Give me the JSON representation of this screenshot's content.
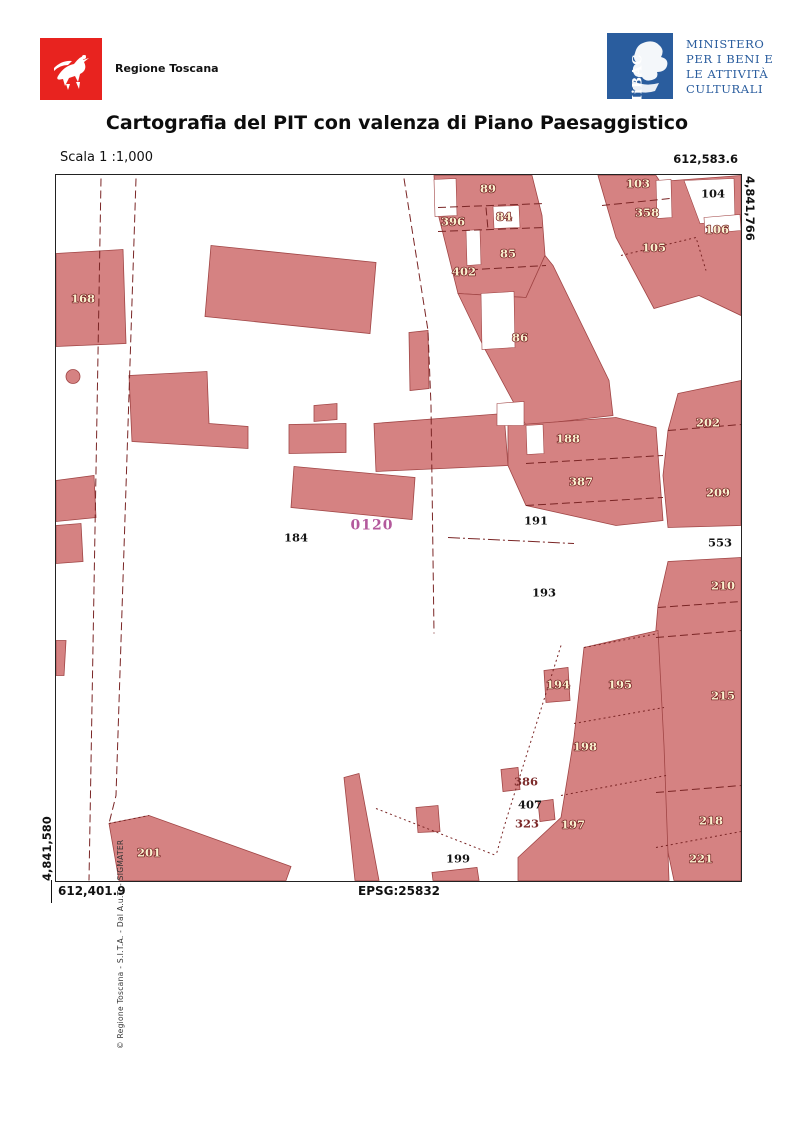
{
  "header": {
    "region_name": "Regione Toscana",
    "ministry_logo_text": "MiBAC",
    "ministry": {
      "l1": "MINISTERO",
      "l2": "PER I BENI E",
      "l3": "LE ATTIVITÀ",
      "l4": "CULTURALI"
    },
    "title": "Cartografia del PIT con valenza di Piano Paesaggistico",
    "scale_label": "Scala 1 :1,000"
  },
  "map": {
    "coordinates": {
      "top_right_easting": "612,583.6",
      "right_northing": "4,841,766",
      "left_northing": "4,841,580",
      "bottom_left_easting": "612,401.9",
      "epsg": "EPSG:25832"
    },
    "credit": "© Regione Toscana - S.I.T.A. - Dal A.u.T. - SIGMATER",
    "colors": {
      "building_fill": "#d58282",
      "building_stroke": "#a04545",
      "parcel_label_light": "#fbf2d0",
      "parcel_label_outline": "#7c2a2a",
      "parcel_label_dark": "#151515",
      "zone_label_purple": "#b3599c",
      "region_logo_red": "#e8231f",
      "ministry_blue": "#2a5d9e"
    },
    "parcels": [
      {
        "t": "168",
        "x": 27,
        "y": 123,
        "s": "A"
      },
      {
        "t": "89",
        "x": 432,
        "y": 13,
        "s": "A"
      },
      {
        "t": "396",
        "x": 397,
        "y": 46,
        "s": "A"
      },
      {
        "t": "84",
        "x": 448,
        "y": 41,
        "s": "A"
      },
      {
        "t": "85",
        "x": 452,
        "y": 78,
        "s": "A"
      },
      {
        "t": "402",
        "x": 408,
        "y": 96,
        "s": "A"
      },
      {
        "t": "86",
        "x": 464,
        "y": 162,
        "s": "A"
      },
      {
        "t": "103",
        "x": 582,
        "y": 8,
        "s": "A"
      },
      {
        "t": "104",
        "x": 657,
        "y": 18,
        "s": "B"
      },
      {
        "t": "358",
        "x": 591,
        "y": 37,
        "s": "A"
      },
      {
        "t": "106",
        "x": 661,
        "y": 54,
        "s": "A"
      },
      {
        "t": "105",
        "x": 598,
        "y": 72,
        "s": "A"
      },
      {
        "t": "188",
        "x": 512,
        "y": 263,
        "s": "A"
      },
      {
        "t": "387",
        "x": 525,
        "y": 306,
        "s": "A"
      },
      {
        "t": "191",
        "x": 480,
        "y": 345,
        "s": "B"
      },
      {
        "t": "193",
        "x": 488,
        "y": 417,
        "s": "B"
      },
      {
        "t": "184",
        "x": 240,
        "y": 362,
        "s": "B"
      },
      {
        "t": "202",
        "x": 652,
        "y": 247,
        "s": "A"
      },
      {
        "t": "209",
        "x": 662,
        "y": 317,
        "s": "A"
      },
      {
        "t": "553",
        "x": 664,
        "y": 367,
        "s": "B"
      },
      {
        "t": "210",
        "x": 667,
        "y": 410,
        "s": "A"
      },
      {
        "t": "215",
        "x": 667,
        "y": 520,
        "s": "A"
      },
      {
        "t": "218",
        "x": 655,
        "y": 645,
        "s": "A"
      },
      {
        "t": "221",
        "x": 645,
        "y": 683,
        "s": "A"
      },
      {
        "t": "194",
        "x": 502,
        "y": 509,
        "s": "A"
      },
      {
        "t": "195",
        "x": 564,
        "y": 509,
        "s": "A"
      },
      {
        "t": "198",
        "x": 529,
        "y": 571,
        "s": "A"
      },
      {
        "t": "386",
        "x": 470,
        "y": 606,
        "s": "C"
      },
      {
        "t": "407",
        "x": 474,
        "y": 629,
        "s": "B"
      },
      {
        "t": "323",
        "x": 471,
        "y": 648,
        "s": "C"
      },
      {
        "t": "197",
        "x": 517,
        "y": 649,
        "s": "A"
      },
      {
        "t": "199",
        "x": 402,
        "y": 683,
        "s": "B"
      },
      {
        "t": "201",
        "x": 93,
        "y": 677,
        "s": "A"
      },
      {
        "t": "0120",
        "x": 316,
        "y": 350,
        "s": "D"
      }
    ]
  }
}
